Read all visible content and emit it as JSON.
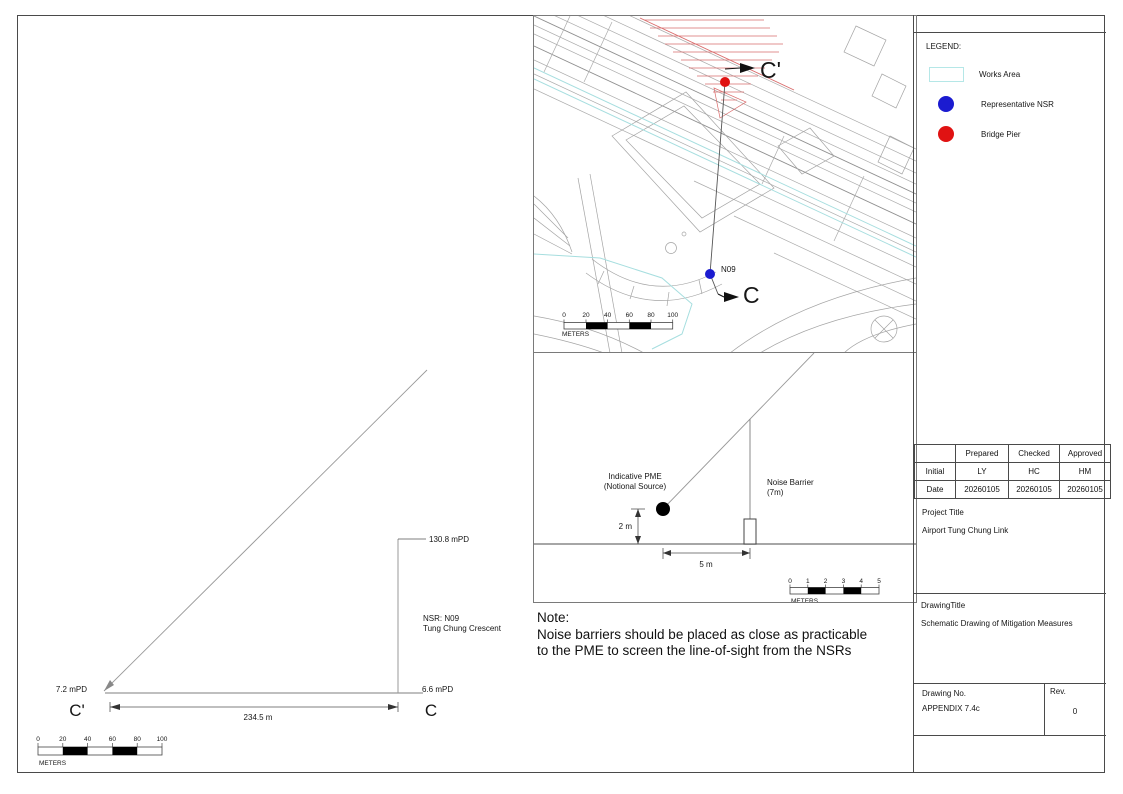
{
  "legend": {
    "title": "LEGEND:",
    "items": [
      {
        "name": "works-area",
        "label": "Works Area",
        "swatch_color": "#b5e7e7"
      },
      {
        "name": "representative-nsr",
        "label": "Representative NSR",
        "swatch_color": "#1b1bd0"
      },
      {
        "name": "bridge-pier",
        "label": "Bridge Pier",
        "swatch_color": "#e01212"
      }
    ]
  },
  "map": {
    "marker_start": "C'",
    "marker_end": "C",
    "nsr_point": "N09",
    "scalebar": {
      "ticks": [
        "0",
        "20",
        "40",
        "60",
        "80",
        "100"
      ],
      "unit": "METERS"
    }
  },
  "detail": {
    "pme_label": [
      "Indicative PME",
      "(Notional Source)"
    ],
    "barrier_label": [
      "Noise Barrier",
      "(7m)"
    ],
    "height_dim": "2 m",
    "distance_dim": "5 m",
    "scalebar": {
      "ticks": [
        "0",
        "1",
        "2",
        "3",
        "4",
        "5"
      ],
      "unit": "METERS"
    }
  },
  "section": {
    "marker_start": "C'",
    "marker_end": "C",
    "level_left": "7.2 mPD",
    "level_right": "6.6 mPD",
    "level_top": "130.8 mPD",
    "nsr_label": [
      "NSR: N09",
      "Tung Chung Crescent"
    ],
    "span_dim": "234.5 m",
    "scalebar": {
      "ticks": [
        "0",
        "20",
        "40",
        "60",
        "80",
        "100"
      ],
      "unit": "METERS"
    }
  },
  "note": {
    "heading": "Note:",
    "lines": [
      "Noise barriers should be placed as close as practicable",
      "to the PME to screen the line-of-sight from the NSRs"
    ]
  },
  "titleblock": {
    "approval_table": {
      "headers": [
        "",
        "Prepared",
        "Checked",
        "Approved"
      ],
      "rows": [
        {
          "label": "Initial",
          "values": [
            "LY",
            "HC",
            "HM"
          ]
        },
        {
          "label": "Date",
          "values": [
            "20260105",
            "20260105",
            "20260105"
          ]
        }
      ]
    },
    "project_title_label": "Project Title",
    "project_title": "Airport Tung Chung Link",
    "drawing_title_label": "DrawingTitle",
    "drawing_title": "Schematic Drawing of Mitigation Measures",
    "drawing_no_label": "Drawing No.",
    "drawing_no": "APPENDIX 7.4c",
    "rev_label": "Rev.",
    "rev": "0"
  }
}
